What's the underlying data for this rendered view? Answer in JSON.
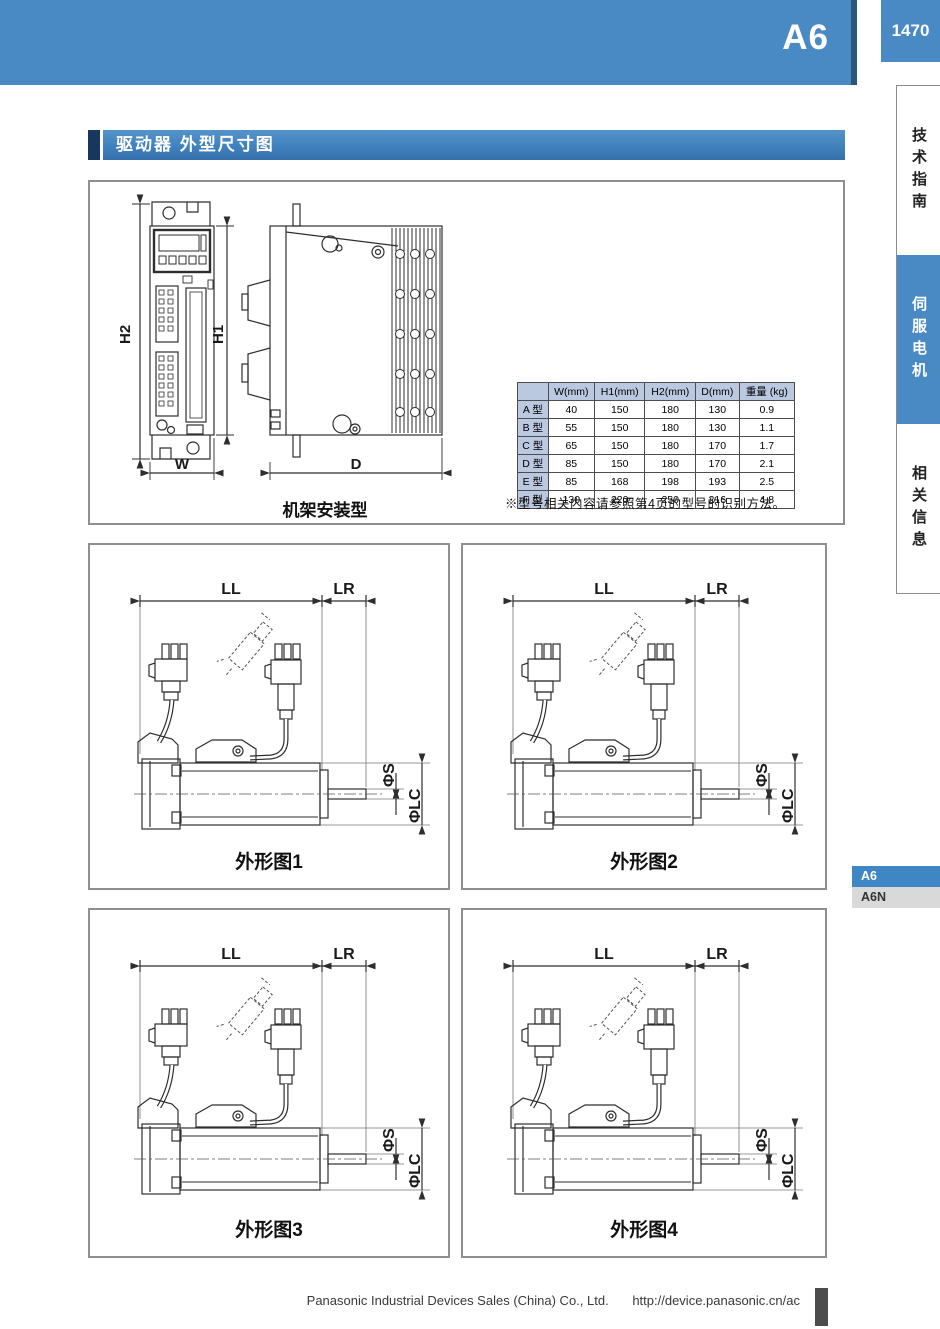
{
  "header": {
    "series": "A6",
    "page_number": "1470"
  },
  "sidebar": {
    "tabs": [
      {
        "label": "技术指南",
        "active": false
      },
      {
        "label": "伺服电机",
        "active": true
      },
      {
        "label": "相关信息",
        "active": false
      }
    ],
    "series_tabs": [
      {
        "label": "A6",
        "active": true
      },
      {
        "label": "A6N",
        "active": false
      }
    ]
  },
  "section_title": "驱动器 外型尺寸图",
  "driver_figure": {
    "caption": "机架安装型",
    "dim_h2": "H2",
    "dim_h1": "H1",
    "dim_w": "W",
    "dim_d": "D"
  },
  "spec_table": {
    "headers": [
      "",
      "W(mm)",
      "H1(mm)",
      "H2(mm)",
      "D(mm)",
      "重量 (kg)"
    ],
    "rows": [
      {
        "type": "A 型",
        "w": "40",
        "h1": "150",
        "h2": "180",
        "d": "130",
        "weight": "0.9"
      },
      {
        "type": "B 型",
        "w": "55",
        "h1": "150",
        "h2": "180",
        "d": "130",
        "weight": "1.1"
      },
      {
        "type": "C 型",
        "w": "65",
        "h1": "150",
        "h2": "180",
        "d": "170",
        "weight": "1.7"
      },
      {
        "type": "D 型",
        "w": "85",
        "h1": "150",
        "h2": "180",
        "d": "170",
        "weight": "2.1"
      },
      {
        "type": "E 型",
        "w": "85",
        "h1": "168",
        "h2": "198",
        "d": "193",
        "weight": "2.5"
      },
      {
        "type": "F 型",
        "w": "130",
        "h1": "220",
        "h2": "250",
        "d": "216",
        "weight": "4.8"
      }
    ],
    "note": "※型号相关内容请参照第4页的型号的识别方法。"
  },
  "dim_labels": {
    "ll": "LL",
    "lr": "LR",
    "phi_s": "ΦS",
    "phi_lc": "ΦLC"
  },
  "outline_figures": [
    {
      "caption": "外形图1"
    },
    {
      "caption": "外形图2"
    },
    {
      "caption": "外形图3"
    },
    {
      "caption": "外形图4"
    }
  ],
  "footer": {
    "company": "Panasonic Industrial Devices Sales (China) Co., Ltd.",
    "url": "http://device.panasonic.cn/ac"
  },
  "colors": {
    "accent_blue": "#4a8ac4",
    "title_navy": "#17375e",
    "table_header_bg": "#bac9e0",
    "inactive_tab_gray": "#d9d9d9"
  }
}
